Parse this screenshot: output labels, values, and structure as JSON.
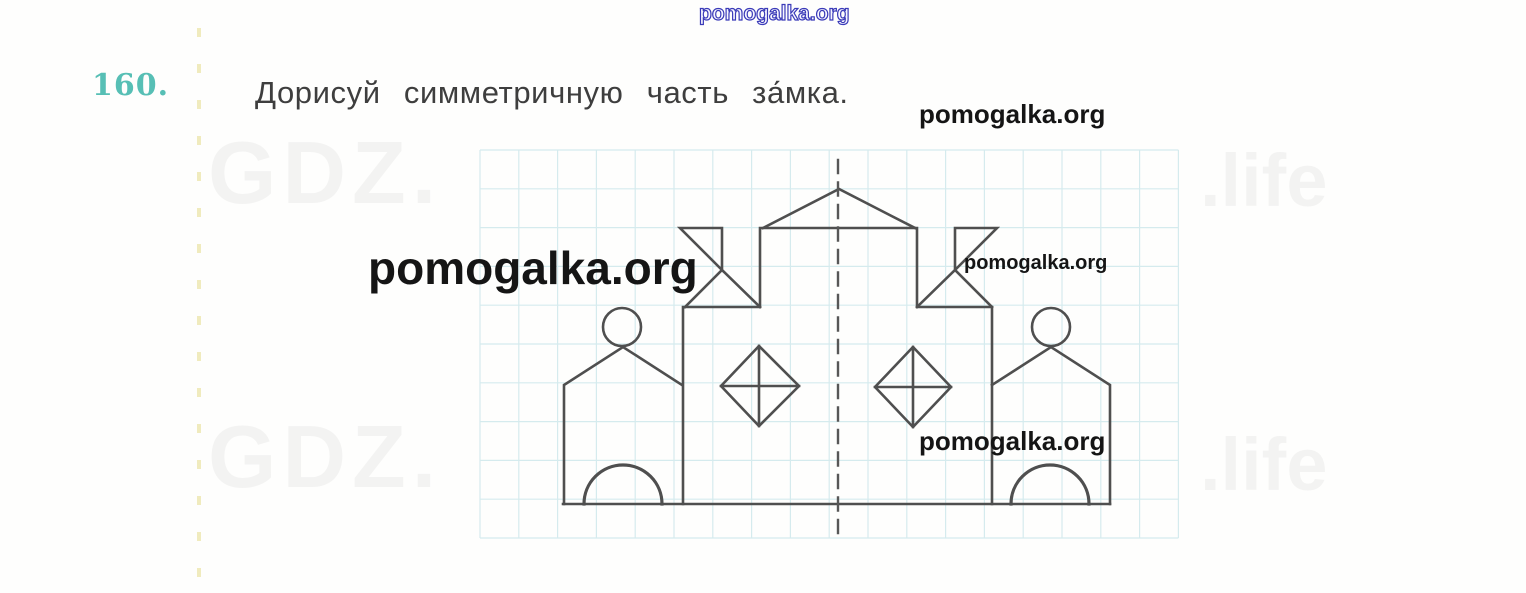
{
  "task": {
    "number": "160.",
    "title": "Дорисуй симметричную часть за́мка."
  },
  "watermarks": {
    "top_center": "pomogalka.org",
    "upper_right": "pomogalka.org",
    "large_left": "pomogalka.org",
    "mid_right": "pomogalka.org",
    "lower_right": "pomogalka.org",
    "faint_top_left": "GDZ.",
    "faint_top_right": ".life",
    "faint_bottom_left": "GDZ.",
    "faint_bottom_right": ".life"
  },
  "colors": {
    "task_number": "#57bfb5",
    "title_text": "#3e3e3e",
    "watermark_black": "#151515",
    "watermark_blue_outline": "#3a3ab8",
    "castle_line": "#4f4f4f",
    "grid_line": "#d5ebee",
    "axis_line": "#575757",
    "margin_dashes": "#ece5a9"
  },
  "drawing": {
    "grid": {
      "x": 480,
      "y": 150,
      "cols": 18,
      "rows": 10,
      "cell": 38.8
    },
    "stroke_width": 2.6,
    "paths": [
      {
        "name": "castle-base-line",
        "d": "M 563 504 L 1110 504"
      },
      {
        "name": "left-tower-outline",
        "d": "M 564 504 L 564 385 L 623 347 L 682 385"
      },
      {
        "name": "left-tower-arch",
        "d": "M 584 504 A 39 39 0 0 1 662 504",
        "width": 3.2
      },
      {
        "name": "main-body-outline",
        "d": "M 683 504 L 683 307 L 760 307 L 760 228 L 917 228 L 917 307 L 992 307 L 992 504"
      },
      {
        "name": "central-roof-triangle",
        "d": "M 763 228 L 839 189 L 915 228"
      },
      {
        "name": "left-flag",
        "d": "M 722 270 L 722 228 L 680 228 Z M 685 307 L 722 270 L 760 307"
      },
      {
        "name": "right-flag",
        "d": "M 955 270 L 955 228 L 997 228 Z M 917 307 L 955 270 L 992 307"
      },
      {
        "name": "right-tower-outline",
        "d": "M 992 385 L 1051 347 L 1110 385 L 1110 504"
      },
      {
        "name": "right-tower-arch",
        "d": "M 1011 504 A 39 39 0 0 1 1089 504",
        "width": 3.2
      },
      {
        "name": "left-diamond-window",
        "d": "M 759 346 L 799 386 L 759 426 L 721 386 Z M 721 386 L 799 386 M 759 346 L 759 426"
      },
      {
        "name": "right-diamond-window",
        "d": "M 913 347 L 951 387 L 913 427 L 875 387 Z M 875 387 L 951 387 M 913 347 L 913 427"
      },
      {
        "name": "symmetry-axis",
        "d": "M 838 160 L 838 533",
        "dash": "13 9.5",
        "width": 2.4,
        "color": "#575757"
      }
    ],
    "circles": [
      {
        "name": "left-tower-circle",
        "cx": 622,
        "cy": 327,
        "r": 19
      },
      {
        "name": "right-tower-circle",
        "cx": 1051,
        "cy": 327,
        "r": 19
      }
    ]
  }
}
